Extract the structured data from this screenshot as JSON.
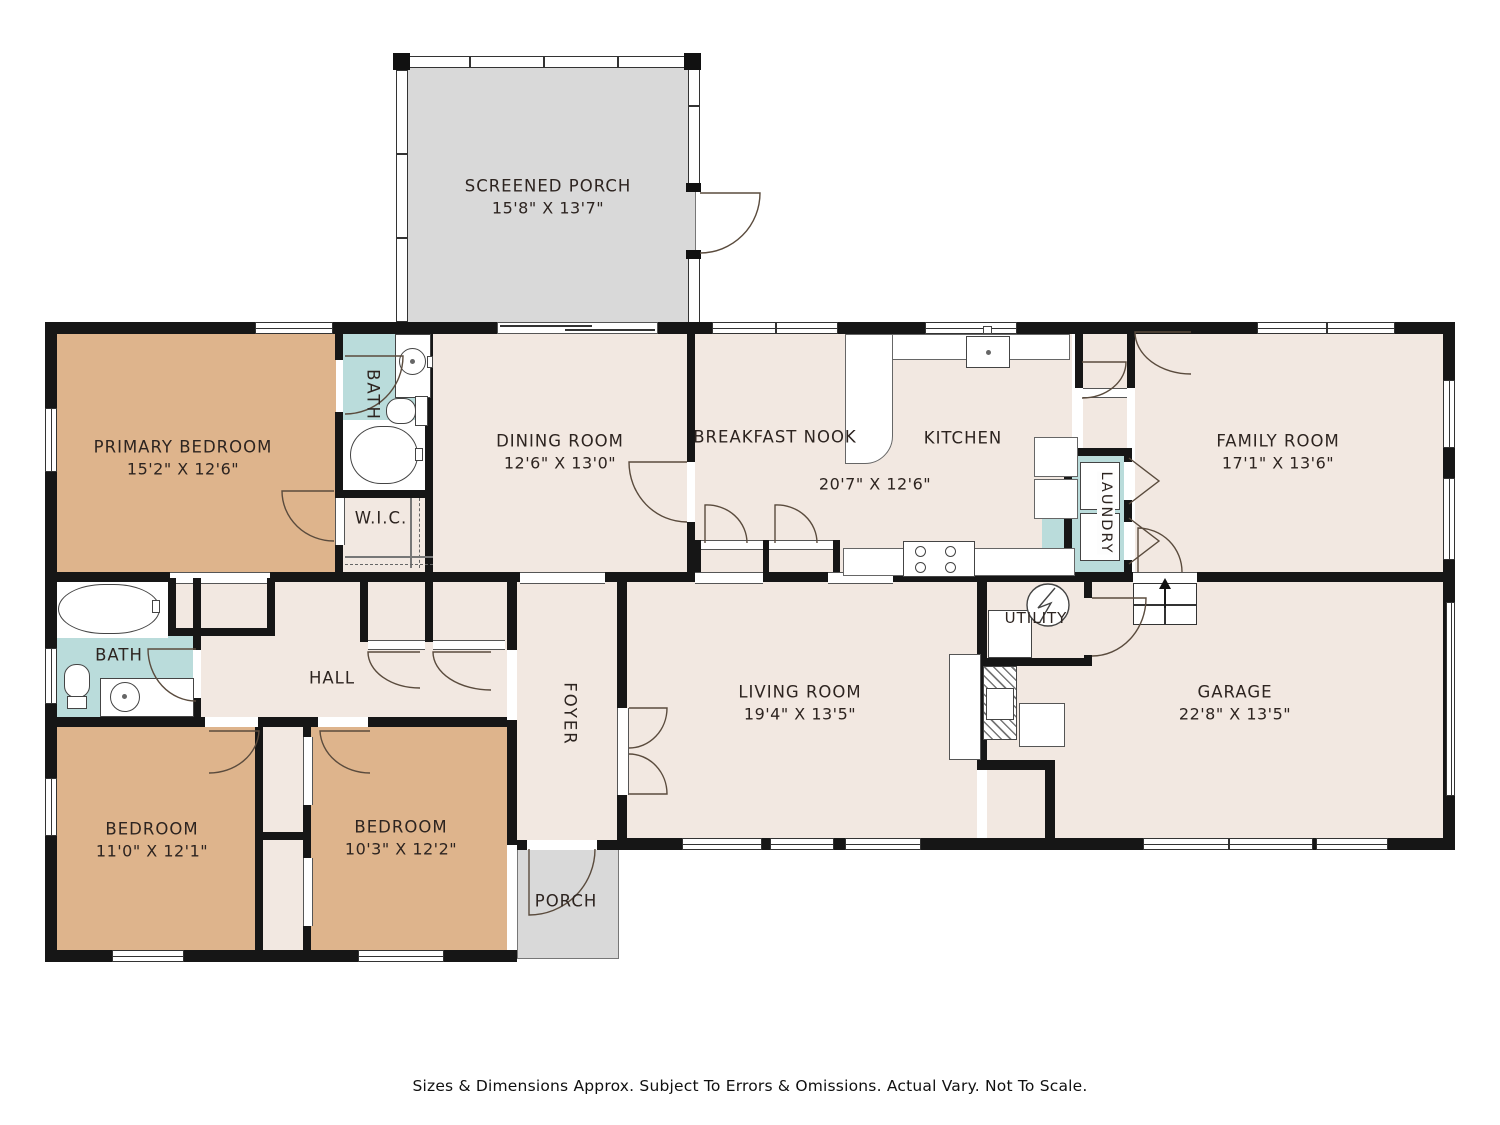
{
  "colors": {
    "bedroom_fill": "#deb48c",
    "bath_fill": "#badcdb",
    "floor_fill": "#f2e8e1",
    "porch_fill": "#d9d9d9",
    "wall": "#161616"
  },
  "rooms": {
    "screened_porch": {
      "name": "SCREENED PORCH",
      "dims": "15'8\" X 13'7\""
    },
    "primary_bedroom": {
      "name": "PRIMARY BEDROOM",
      "dims": "15'2\" X 12'6\""
    },
    "primary_bath": {
      "name": "BATH"
    },
    "wic": {
      "name": "W.I.C."
    },
    "dining_room": {
      "name": "DINING ROOM",
      "dims": "12'6\" X 13'0\""
    },
    "breakfast_nook": {
      "name": "BREAKFAST NOOK"
    },
    "kitchen": {
      "name": "KITCHEN"
    },
    "kitchen_nook_dims": {
      "dims": "20'7\" X 12'6\""
    },
    "laundry": {
      "name": "LAUNDRY"
    },
    "family_room": {
      "name": "FAMILY ROOM",
      "dims": "17'1\" X 13'6\""
    },
    "hall_bath": {
      "name": "BATH"
    },
    "hall": {
      "name": "HALL"
    },
    "foyer": {
      "name": "FOYER"
    },
    "living_room": {
      "name": "LIVING ROOM",
      "dims": "19'4\" X 13'5\""
    },
    "utility": {
      "name": "UTILITY"
    },
    "garage": {
      "name": "GARAGE",
      "dims": "22'8\" X 13'5\""
    },
    "bedroom_left": {
      "name": "BEDROOM",
      "dims": "11'0\" X 12'1\""
    },
    "bedroom_middle": {
      "name": "BEDROOM",
      "dims": "10'3\" X 12'2\""
    },
    "front_porch": {
      "name": "PORCH"
    }
  },
  "footer": {
    "disclaimer": "Sizes & Dimensions Approx. Subject To Errors & Omissions. Actual Vary. Not To Scale."
  }
}
